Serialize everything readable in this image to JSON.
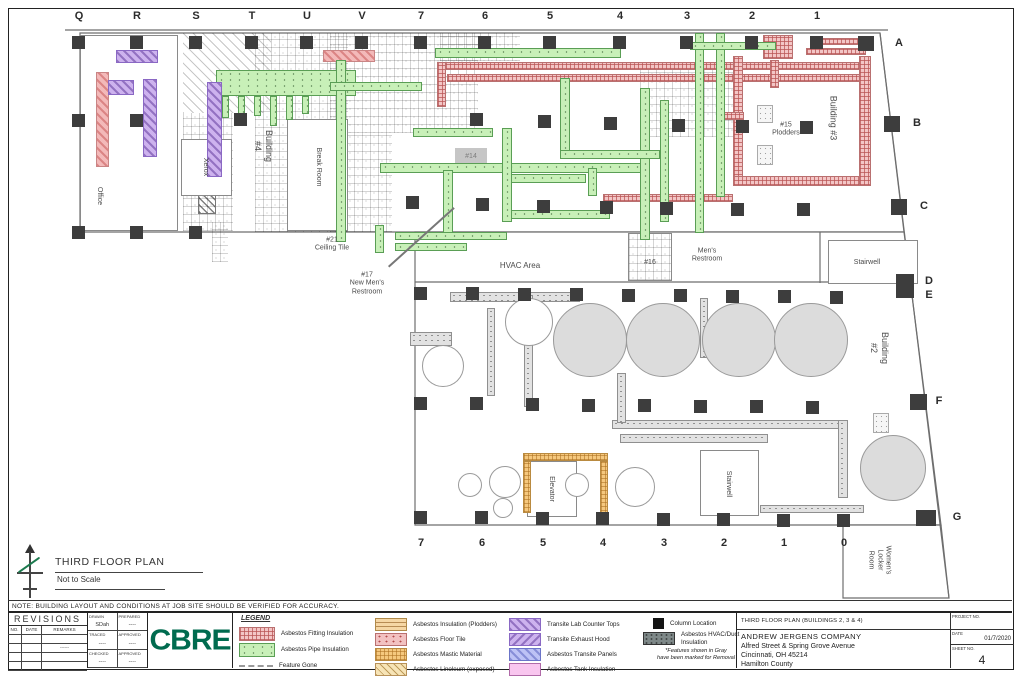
{
  "sheet": {
    "note": "NOTE: BUILDING LAYOUT AND CONDITIONS AT JOB SITE SHOULD BE VERIFIED FOR ACCURACY.",
    "plan_title": "THIRD FLOOR PLAN",
    "plan_scale": "Not to Scale"
  },
  "grid": {
    "top": [
      {
        "t": "Q",
        "x": 79
      },
      {
        "t": "R",
        "x": 137
      },
      {
        "t": "S",
        "x": 196
      },
      {
        "t": "T",
        "x": 252
      },
      {
        "t": "U",
        "x": 307
      },
      {
        "t": "V",
        "x": 362
      },
      {
        "t": "7",
        "x": 421
      },
      {
        "t": "6",
        "x": 485
      },
      {
        "t": "5",
        "x": 550
      },
      {
        "t": "4",
        "x": 620
      },
      {
        "t": "3",
        "x": 687
      },
      {
        "t": "2",
        "x": 752
      },
      {
        "t": "1",
        "x": 817
      }
    ],
    "right": [
      {
        "t": "A",
        "x": 899,
        "y": 43
      },
      {
        "t": "B",
        "x": 917,
        "y": 123
      },
      {
        "t": "C",
        "x": 924,
        "y": 206
      },
      {
        "t": "D",
        "x": 929,
        "y": 281
      },
      {
        "t": "E",
        "x": 929,
        "y": 295
      },
      {
        "t": "F",
        "x": 939,
        "y": 401
      },
      {
        "t": "G",
        "x": 957,
        "y": 517
      }
    ],
    "bottom": [
      {
        "t": "7",
        "x": 421
      },
      {
        "t": "6",
        "x": 482
      },
      {
        "t": "5",
        "x": 543
      },
      {
        "t": "4",
        "x": 603
      },
      {
        "t": "3",
        "x": 664
      },
      {
        "t": "2",
        "x": 724
      },
      {
        "t": "1",
        "x": 784
      },
      {
        "t": "0",
        "x": 844
      }
    ]
  },
  "plan": {
    "outlines": [
      {
        "type": "poly",
        "points": "80,33 880,33 904,232 80,232"
      },
      {
        "type": "poly",
        "points": "415,232 904,232 941,525 415,525"
      },
      {
        "type": "poly",
        "points": "843,525 941,525 949,598 843,598"
      },
      {
        "type": "line",
        "points": "65,30 888,30"
      },
      {
        "type": "line",
        "points": "415,282 906,282"
      },
      {
        "type": "line",
        "points": "820,232 820,283"
      },
      {
        "type": "line",
        "points": "880,33 949,598"
      }
    ],
    "features": [
      {
        "k": "diag",
        "x": 183,
        "y": 33,
        "w": 88,
        "h": 80
      },
      {
        "k": "tile",
        "x": 255,
        "y": 33,
        "w": 93,
        "h": 199
      },
      {
        "k": "tile",
        "x": 183,
        "y": 113,
        "w": 50,
        "h": 118
      },
      {
        "k": "tile",
        "x": 330,
        "y": 33,
        "w": 148,
        "h": 100
      },
      {
        "k": "tile",
        "x": 330,
        "y": 133,
        "w": 62,
        "h": 99
      },
      {
        "k": "tile",
        "x": 640,
        "y": 62,
        "w": 95,
        "h": 75
      },
      {
        "k": "tile",
        "x": 440,
        "y": 33,
        "w": 80,
        "h": 28
      },
      {
        "k": "diagdark",
        "x": 198,
        "y": 194,
        "w": 18,
        "h": 20
      },
      {
        "k": "tile",
        "x": 212,
        "y": 222,
        "w": 16,
        "h": 40
      },
      {
        "k": "tilebox",
        "x": 628,
        "y": 233,
        "w": 44,
        "h": 48
      },
      {
        "k": "room",
        "x": 80,
        "y": 35,
        "w": 98,
        "h": 196
      },
      {
        "k": "room",
        "x": 181,
        "y": 139,
        "w": 51,
        "h": 57
      },
      {
        "k": "room",
        "x": 287,
        "y": 119,
        "w": 61,
        "h": 112
      },
      {
        "k": "room",
        "x": 828,
        "y": 240,
        "w": 90,
        "h": 44
      },
      {
        "k": "room",
        "x": 527,
        "y": 461,
        "w": 50,
        "h": 56
      },
      {
        "k": "room",
        "x": 700,
        "y": 450,
        "w": 59,
        "h": 66
      },
      {
        "k": "duct",
        "x": 450,
        "y": 292,
        "w": 130,
        "h": 10
      },
      {
        "k": "duct",
        "x": 410,
        "y": 332,
        "w": 42,
        "h": 14
      },
      {
        "k": "duct",
        "x": 487,
        "y": 308,
        "w": 8,
        "h": 88
      },
      {
        "k": "duct",
        "x": 524,
        "y": 295,
        "w": 9,
        "h": 112
      },
      {
        "k": "duct",
        "x": 612,
        "y": 420,
        "w": 228,
        "h": 9
      },
      {
        "k": "duct",
        "x": 620,
        "y": 434,
        "w": 148,
        "h": 9
      },
      {
        "k": "duct",
        "x": 617,
        "y": 373,
        "w": 9,
        "h": 50
      },
      {
        "k": "duct",
        "x": 700,
        "y": 298,
        "w": 8,
        "h": 60
      },
      {
        "k": "duct",
        "x": 760,
        "y": 505,
        "w": 104,
        "h": 8
      },
      {
        "k": "duct",
        "x": 838,
        "y": 420,
        "w": 10,
        "h": 78
      },
      {
        "k": "dotbox",
        "x": 873,
        "y": 413,
        "w": 16,
        "h": 20
      },
      {
        "k": "dotbox",
        "x": 757,
        "y": 105,
        "w": 16,
        "h": 18
      },
      {
        "k": "dotbox",
        "x": 757,
        "y": 145,
        "w": 16,
        "h": 20
      },
      {
        "k": "graybox",
        "x": 455,
        "y": 148,
        "w": 32,
        "h": 16,
        "t": "#14"
      },
      {
        "k": "mastic",
        "x": 523,
        "y": 453,
        "w": 85,
        "h": 8
      },
      {
        "k": "mastic",
        "x": 523,
        "y": 461,
        "w": 8,
        "h": 52
      },
      {
        "k": "mastic",
        "x": 600,
        "y": 461,
        "w": 8,
        "h": 55
      },
      {
        "k": "fitting",
        "x": 437,
        "y": 62,
        "w": 428,
        "h": 8
      },
      {
        "k": "fitting",
        "x": 447,
        "y": 74,
        "w": 418,
        "h": 8
      },
      {
        "k": "fitting",
        "x": 437,
        "y": 62,
        "w": 9,
        "h": 45
      },
      {
        "k": "fitting",
        "x": 733,
        "y": 56,
        "w": 10,
        "h": 124
      },
      {
        "k": "fitting",
        "x": 733,
        "y": 176,
        "w": 138,
        "h": 10
      },
      {
        "k": "fitting",
        "x": 859,
        "y": 56,
        "w": 12,
        "h": 130
      },
      {
        "k": "fitting",
        "x": 820,
        "y": 38,
        "w": 46,
        "h": 7
      },
      {
        "k": "fitting",
        "x": 806,
        "y": 48,
        "w": 60,
        "h": 7
      },
      {
        "k": "fitting",
        "x": 763,
        "y": 35,
        "w": 30,
        "h": 24
      },
      {
        "k": "fitting",
        "x": 770,
        "y": 60,
        "w": 9,
        "h": 28
      },
      {
        "k": "fitting",
        "x": 603,
        "y": 194,
        "w": 130,
        "h": 8
      },
      {
        "k": "fitting",
        "x": 718,
        "y": 112,
        "w": 26,
        "h": 8
      },
      {
        "k": "salmon",
        "x": 323,
        "y": 50,
        "w": 52,
        "h": 12
      },
      {
        "k": "pipe",
        "x": 216,
        "y": 70,
        "w": 140,
        "h": 26
      },
      {
        "k": "pipe",
        "x": 222,
        "y": 96,
        "w": 7,
        "h": 22
      },
      {
        "k": "pipe",
        "x": 238,
        "y": 96,
        "w": 7,
        "h": 26
      },
      {
        "k": "pipe",
        "x": 254,
        "y": 96,
        "w": 7,
        "h": 20
      },
      {
        "k": "pipe",
        "x": 270,
        "y": 96,
        "w": 7,
        "h": 30
      },
      {
        "k": "pipe",
        "x": 286,
        "y": 96,
        "w": 7,
        "h": 24
      },
      {
        "k": "pipe",
        "x": 302,
        "y": 96,
        "w": 7,
        "h": 18
      },
      {
        "k": "pipe",
        "x": 336,
        "y": 60,
        "w": 10,
        "h": 182
      },
      {
        "k": "pipe",
        "x": 330,
        "y": 82,
        "w": 92,
        "h": 9
      },
      {
        "k": "pipe",
        "x": 435,
        "y": 48,
        "w": 186,
        "h": 10
      },
      {
        "k": "pipe",
        "x": 413,
        "y": 128,
        "w": 80,
        "h": 9
      },
      {
        "k": "pipe",
        "x": 380,
        "y": 163,
        "w": 262,
        "h": 10
      },
      {
        "k": "pipe",
        "x": 510,
        "y": 174,
        "w": 76,
        "h": 9
      },
      {
        "k": "pipe",
        "x": 510,
        "y": 210,
        "w": 100,
        "h": 9
      },
      {
        "k": "pipe",
        "x": 443,
        "y": 170,
        "w": 10,
        "h": 70
      },
      {
        "k": "pipe",
        "x": 502,
        "y": 128,
        "w": 10,
        "h": 94
      },
      {
        "k": "pipe",
        "x": 560,
        "y": 78,
        "w": 10,
        "h": 76
      },
      {
        "k": "pipe",
        "x": 640,
        "y": 88,
        "w": 10,
        "h": 152
      },
      {
        "k": "pipe",
        "x": 660,
        "y": 100,
        "w": 9,
        "h": 122
      },
      {
        "k": "pipe",
        "x": 695,
        "y": 33,
        "w": 9,
        "h": 200
      },
      {
        "k": "pipe",
        "x": 716,
        "y": 33,
        "w": 9,
        "h": 164
      },
      {
        "k": "pipe",
        "x": 690,
        "y": 42,
        "w": 86,
        "h": 8
      },
      {
        "k": "pipe",
        "x": 560,
        "y": 150,
        "w": 100,
        "h": 9
      },
      {
        "k": "pipe",
        "x": 395,
        "y": 232,
        "w": 112,
        "h": 8
      },
      {
        "k": "pipe",
        "x": 395,
        "y": 243,
        "w": 72,
        "h": 8
      },
      {
        "k": "pipe",
        "x": 375,
        "y": 225,
        "w": 9,
        "h": 28
      },
      {
        "k": "pipe",
        "x": 588,
        "y": 168,
        "w": 9,
        "h": 28
      },
      {
        "k": "counter",
        "x": 116,
        "y": 50,
        "w": 42,
        "h": 13
      },
      {
        "k": "salmon",
        "x": 96,
        "y": 72,
        "w": 13,
        "h": 95
      },
      {
        "k": "counter",
        "x": 108,
        "y": 80,
        "w": 26,
        "h": 15
      },
      {
        "k": "counter",
        "x": 143,
        "y": 79,
        "w": 14,
        "h": 78
      },
      {
        "k": "counter",
        "x": 207,
        "y": 82,
        "w": 15,
        "h": 95
      },
      {
        "k": "tank",
        "x": 553,
        "y": 303,
        "w": 74,
        "h": 74
      },
      {
        "k": "tank",
        "x": 626,
        "y": 303,
        "w": 74,
        "h": 74
      },
      {
        "k": "tank",
        "x": 702,
        "y": 303,
        "w": 74,
        "h": 74
      },
      {
        "k": "tank",
        "x": 774,
        "y": 303,
        "w": 74,
        "h": 74
      },
      {
        "k": "tank",
        "x": 860,
        "y": 435,
        "w": 66,
        "h": 66
      },
      {
        "k": "circle",
        "x": 422,
        "y": 345,
        "w": 42,
        "h": 42
      },
      {
        "k": "circle",
        "x": 505,
        "y": 298,
        "w": 48,
        "h": 48
      },
      {
        "k": "circle",
        "x": 458,
        "y": 473,
        "w": 24,
        "h": 24
      },
      {
        "k": "circle",
        "x": 489,
        "y": 466,
        "w": 32,
        "h": 32
      },
      {
        "k": "circle",
        "x": 493,
        "y": 498,
        "w": 20,
        "h": 20
      },
      {
        "k": "circle",
        "x": 565,
        "y": 473,
        "w": 24,
        "h": 24
      },
      {
        "k": "circle",
        "x": 615,
        "y": 467,
        "w": 40,
        "h": 40
      },
      {
        "k": "leader",
        "x": 388,
        "y": 266,
        "w": 88,
        "h": 1.5,
        "rot": -42
      }
    ],
    "columns": [
      [
        72,
        36
      ],
      [
        130,
        36
      ],
      [
        189,
        36
      ],
      [
        245,
        36
      ],
      [
        300,
        36
      ],
      [
        355,
        36
      ],
      [
        414,
        36
      ],
      [
        478,
        36
      ],
      [
        543,
        36
      ],
      [
        613,
        36
      ],
      [
        680,
        36
      ],
      [
        745,
        36
      ],
      [
        810,
        36
      ],
      [
        858,
        36,
        16,
        15
      ],
      [
        72,
        114
      ],
      [
        130,
        114
      ],
      [
        234,
        113
      ],
      [
        470,
        113
      ],
      [
        538,
        115
      ],
      [
        604,
        117
      ],
      [
        672,
        119
      ],
      [
        736,
        120
      ],
      [
        800,
        121
      ],
      [
        884,
        116,
        16,
        16
      ],
      [
        406,
        196
      ],
      [
        476,
        198
      ],
      [
        537,
        200
      ],
      [
        600,
        201
      ],
      [
        660,
        202
      ],
      [
        731,
        203
      ],
      [
        797,
        203
      ],
      [
        891,
        199,
        16,
        16
      ],
      [
        72,
        226
      ],
      [
        130,
        226
      ],
      [
        189,
        226
      ],
      [
        896,
        274,
        18,
        24
      ],
      [
        414,
        287
      ],
      [
        466,
        287
      ],
      [
        518,
        288
      ],
      [
        570,
        288
      ],
      [
        622,
        289
      ],
      [
        674,
        289
      ],
      [
        726,
        290
      ],
      [
        778,
        290
      ],
      [
        830,
        291
      ],
      [
        414,
        397
      ],
      [
        470,
        397
      ],
      [
        526,
        398
      ],
      [
        582,
        399
      ],
      [
        638,
        399
      ],
      [
        694,
        400
      ],
      [
        750,
        400
      ],
      [
        806,
        401
      ],
      [
        910,
        394,
        17,
        16
      ],
      [
        414,
        511
      ],
      [
        475,
        511
      ],
      [
        536,
        512
      ],
      [
        596,
        512
      ],
      [
        657,
        513
      ],
      [
        717,
        513
      ],
      [
        777,
        514
      ],
      [
        837,
        514
      ],
      [
        916,
        510,
        20,
        16
      ]
    ],
    "labels": [
      {
        "t": "Office",
        "x": 99,
        "y": 196,
        "s": 7,
        "r": 90
      },
      {
        "t": "Xerox",
        "x": 205,
        "y": 167,
        "s": 7,
        "r": 90
      },
      {
        "t": "Building\n#4",
        "x": 263,
        "y": 146,
        "s": 9,
        "r": 90
      },
      {
        "t": "Break Room",
        "x": 318,
        "y": 167,
        "s": 7,
        "r": 90
      },
      {
        "t": "#21\nCeiling Tile",
        "x": 332,
        "y": 245,
        "s": 7
      },
      {
        "t": "#17\nNew Men's\nRestroom",
        "x": 367,
        "y": 284,
        "s": 7
      },
      {
        "t": "HVAC Area",
        "x": 520,
        "y": 266,
        "s": 8
      },
      {
        "t": "#16",
        "x": 650,
        "y": 263,
        "s": 7
      },
      {
        "t": "Men's\nRestroom",
        "x": 707,
        "y": 256,
        "s": 7
      },
      {
        "t": "#15\nPlodders",
        "x": 786,
        "y": 130,
        "s": 7
      },
      {
        "t": "Building #3",
        "x": 833,
        "y": 118,
        "s": 9,
        "r": 90
      },
      {
        "t": "Stairwell",
        "x": 867,
        "y": 263,
        "s": 7
      },
      {
        "t": "Building\n#2",
        "x": 879,
        "y": 348,
        "s": 9,
        "r": 90
      },
      {
        "t": "Elevator",
        "x": 551,
        "y": 489,
        "s": 7,
        "r": 90
      },
      {
        "t": "Stairwell",
        "x": 728,
        "y": 484,
        "s": 7,
        "r": 90
      },
      {
        "t": "Women's\nLocker\nRoom",
        "x": 879,
        "y": 560,
        "s": 7,
        "r": 90
      }
    ]
  },
  "revisions": {
    "title": "REVISIONS",
    "cols": [
      "NO.",
      "DATE",
      "REMARKS"
    ],
    "rows": [
      [
        "",
        "",
        ""
      ],
      [
        "",
        "",
        "------"
      ],
      [
        "",
        "",
        ""
      ],
      [
        "",
        "",
        ""
      ]
    ]
  },
  "stamp": {
    "cells": [
      {
        "k": "DRAWN",
        "v": "SDah"
      },
      {
        "k": "PREPARED",
        "v": "----"
      },
      {
        "k": "TRACED",
        "v": "----"
      },
      {
        "k": "APPROVED",
        "v": "----"
      },
      {
        "k": "CHECKED",
        "v": "----"
      },
      {
        "k": "APPROVED",
        "v": "----"
      }
    ]
  },
  "logo": "CBRE",
  "legend": {
    "title": "LEGEND",
    "col1": [
      {
        "kind": "fitting",
        "label": "Asbestos Fitting Insulation"
      },
      {
        "kind": "pipe",
        "label": "Asbestos Pipe Insulation"
      },
      {
        "kind": "gone",
        "label": "Feature Gone"
      }
    ],
    "col2": [
      {
        "kind": "plodder",
        "label": "Asbestos Insulation (Plodders)"
      },
      {
        "kind": "floortile",
        "label": "Asbestos Floor Tile"
      },
      {
        "kind": "mastic",
        "label": "Asbestos Mastic Material"
      },
      {
        "kind": "linoleum",
        "label": "Asbestos Linoleum (exposed)"
      }
    ],
    "col3": [
      {
        "kind": "counter",
        "label": "Transite Lab Counter Tops"
      },
      {
        "kind": "hood",
        "label": "Transite Exhaust Hood"
      },
      {
        "kind": "panels",
        "label": "Asbestos Transite Panels"
      },
      {
        "kind": "tanksol",
        "label": "Asbestos Tank Insulation"
      }
    ],
    "col4": [
      {
        "kind": "colsq",
        "label": "Column Location"
      },
      {
        "kind": "ductdark",
        "label": "Asbestos HVAC/Duct\nInsulation"
      }
    ],
    "note": "*Features shown in Gray\nhave been marked for Removal"
  },
  "titleblock": {
    "drawing_title": "THIRD FLOOR PLAN (BUILDINGS 2, 3 & 4)",
    "company": "ANDREW JERGENS COMPANY",
    "address1": "Alfred Street & Spring Grove Avenue",
    "address2": "Cincinnati, OH 45214",
    "address3": "Hamilton County",
    "project_no_label": "PROJECT NO.",
    "date_label": "DATE",
    "date": "01/7/2020",
    "sheet_label": "SHEET NO.",
    "sheet": "4"
  },
  "colors": {
    "brand_green": "#006b4f",
    "fitting_pink": "#f3c6c6",
    "pipe_green": "#c8f0b8",
    "transite_purple": "#cdb2ee",
    "panels_blue": "#bdc2f5",
    "tank_pink": "#f9c6ef",
    "removal_gray": "#dcdcdc",
    "column_black": "#3d3d3d"
  }
}
